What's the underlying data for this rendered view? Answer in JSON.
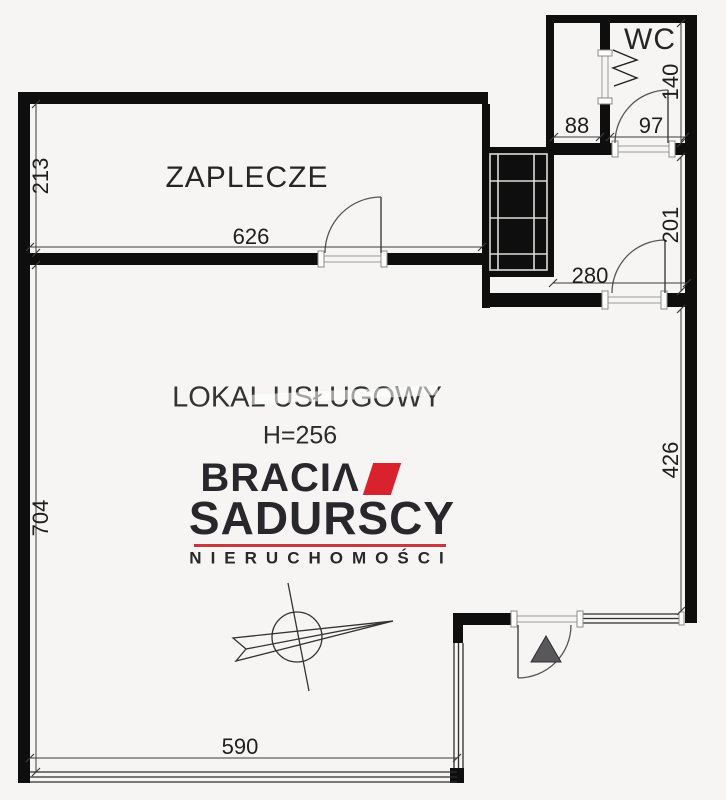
{
  "rooms": {
    "zaplecze": "ZAPLECZE",
    "wc": "WC",
    "main": "LOKAL USŁUGOWY",
    "main_ceiling": "H=256"
  },
  "dimensions": {
    "d213": "213",
    "d626": "626",
    "d704": "704",
    "d88": "88",
    "d97": "97",
    "d140": "140",
    "d201": "201",
    "d280": "280",
    "d426": "426",
    "d590": "590"
  },
  "logo": {
    "brand_line1": "BRACIΛ",
    "brand_line2": "SADURSCY",
    "tagline": "NIERUCHOMOŚCI"
  },
  "symbols": {
    "compass": "compass-rose",
    "entrance_marker": "entrance-triangle",
    "stairs": "stair-shaft",
    "wc_fixture": "zigzag-fixture"
  },
  "colors": {
    "wall": "#0e0e0e",
    "line_dark": "#3c3c3c",
    "line_mid": "#555555",
    "logo_red": "#d8232e",
    "logo_line_red": "#c53840",
    "logo_dark": "#28272c",
    "text": "#1e1e1e",
    "bg": "#f6f5f3",
    "marker_gray": "#58585a"
  }
}
